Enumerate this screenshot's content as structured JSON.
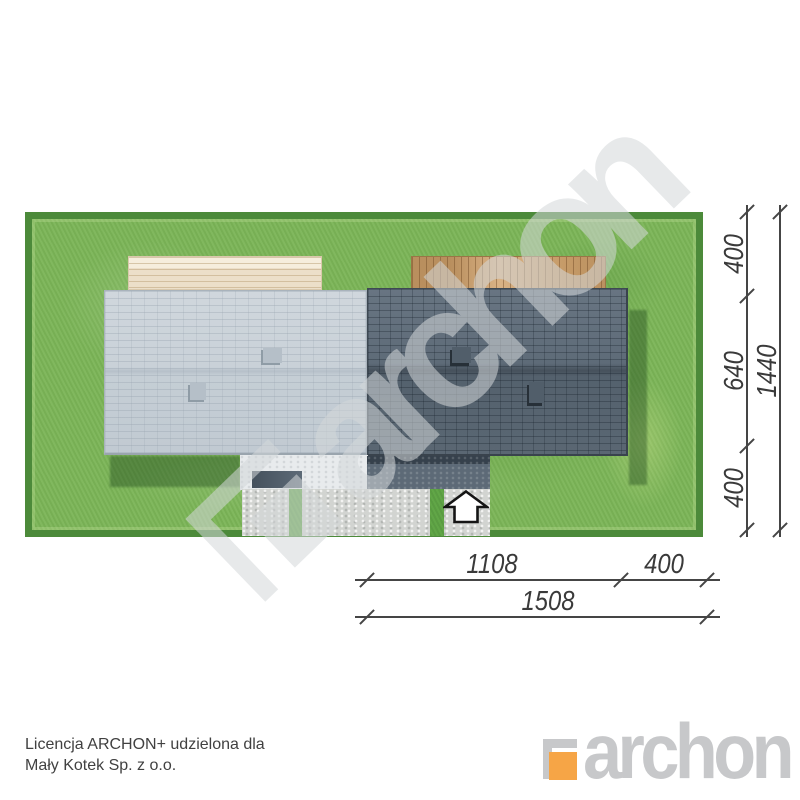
{
  "plan": {
    "dimensions_right": {
      "seg_top": "400",
      "seg_mid": "640",
      "seg_bottom": "400",
      "total": "1440"
    },
    "dimensions_bottom": {
      "seg_left": "1108",
      "seg_right": "400",
      "total": "1508"
    }
  },
  "license": {
    "line1": "Licencja ARCHON+ udzielona dla",
    "line2": "Mały Kotek Sp. z o.o."
  },
  "branding": {
    "logo_text": "archon",
    "watermark_text": "archon",
    "accent_orange": "#f6a546",
    "logo_gray": "#c7c8ca"
  },
  "colors": {
    "grass": "#7cb558",
    "grass_border": "#4c8a3a",
    "roof_left": "#c9d1d8",
    "roof_right": "#5e6b78",
    "terrace_left": "#ecdfc9",
    "terrace_right": "#c59a67",
    "paving_light": "#d2d4d1",
    "paving_dark": "#5d6a77",
    "dimension_text": "#3a3a3a"
  },
  "icons": {
    "entrance_arrow": "block-arrow-up"
  }
}
